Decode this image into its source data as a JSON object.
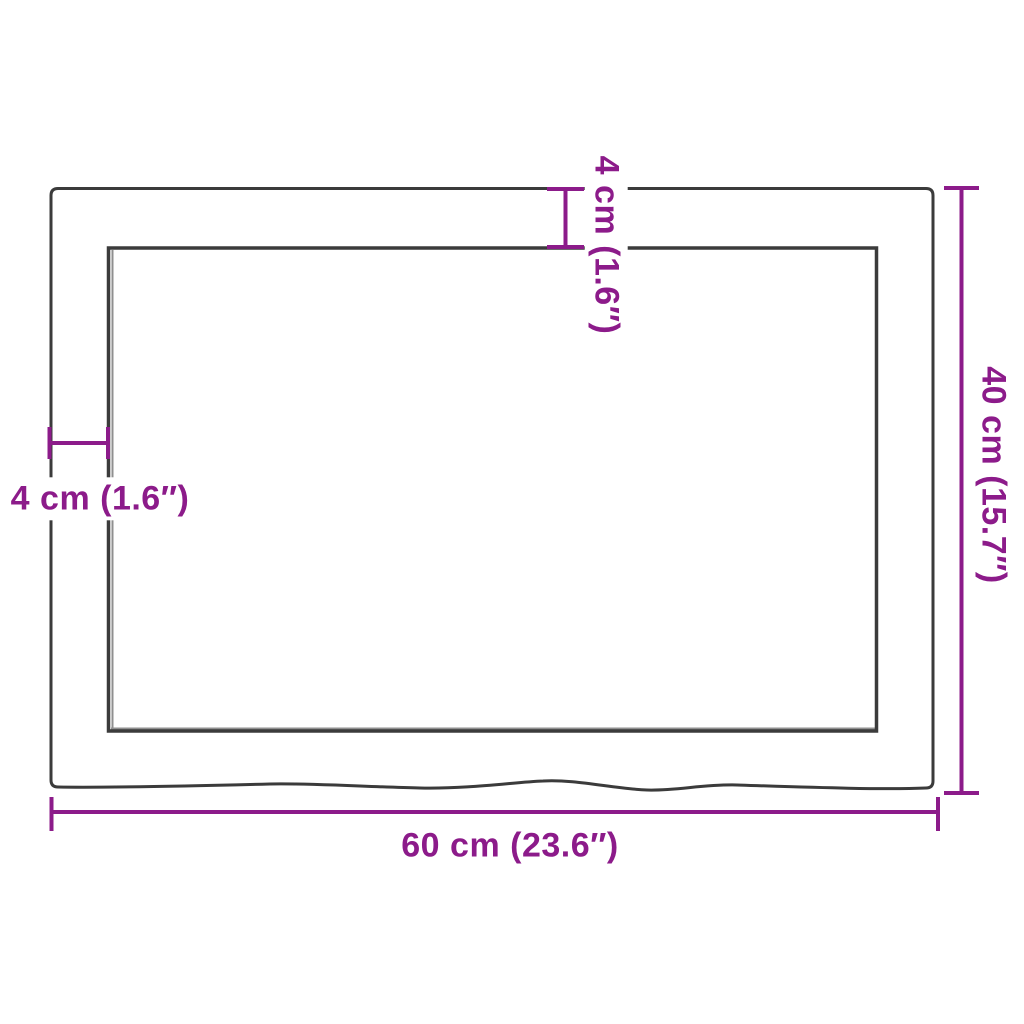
{
  "figure": {
    "title": "Panel dimension diagram",
    "labels": {
      "width": "60 cm (23.6″)",
      "height": "40 cm (15.7″)",
      "top_offset": "4 cm (1.6″)",
      "left_offset": "4 cm (1.6″)"
    },
    "measurements": {
      "width_cm": 60,
      "width_in": 23.6,
      "height_cm": 40,
      "height_in": 15.7,
      "edge_offset_cm": 4,
      "edge_offset_in": 1.6
    }
  },
  "colors": {
    "dimension_accent": "#8c1b8a",
    "outline": "#3b3b3b",
    "recess_shadow": "#8f8f8f",
    "background": "#ffffff"
  }
}
